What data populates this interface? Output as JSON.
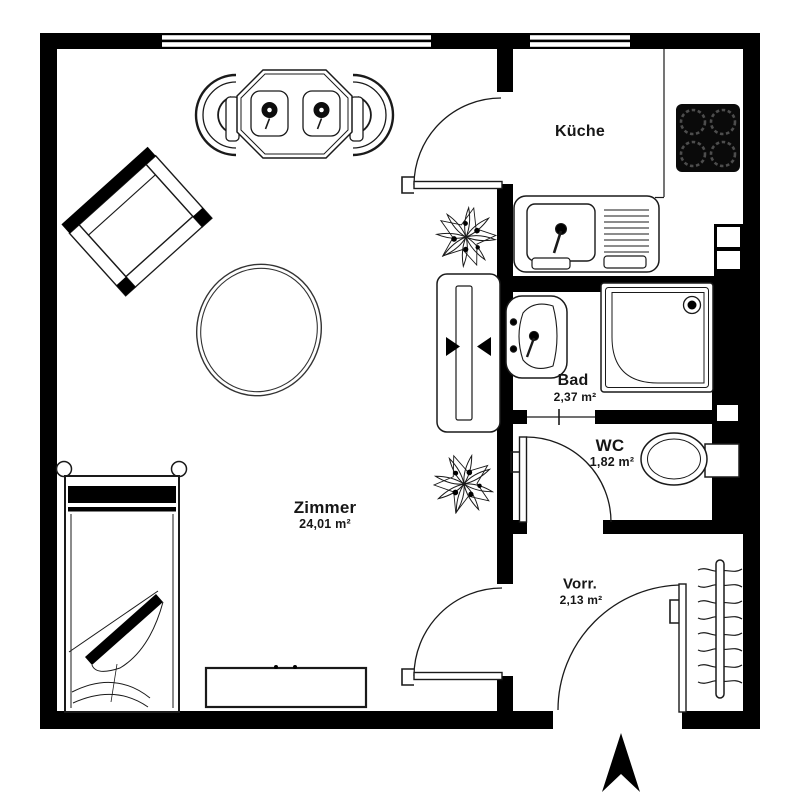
{
  "floorplan": {
    "type": "apartment-floor-plan",
    "rooms": {
      "zimmer": {
        "label": "Zimmer",
        "area": "24,01 m²"
      },
      "kueche": {
        "label": "Küche"
      },
      "bad": {
        "label": "Bad",
        "area": "2,37 m²"
      },
      "wc": {
        "label": "WC",
        "area": "1,82 m²"
      },
      "vorraum": {
        "label": "Vorr.",
        "area": "2,13 m²"
      }
    },
    "furniture": [
      "dining-table-with-two-chairs",
      "armchair",
      "oval-rug",
      "single-bed",
      "sideboard",
      "tv-board",
      "plant",
      "plant",
      "kitchen-counter",
      "kitchen-sink",
      "stove-4-burners",
      "washbasin",
      "shower",
      "toilet",
      "coat-rack",
      "north-arrow"
    ],
    "colors": {
      "wall": "#000000",
      "background": "#ffffff",
      "line": "#1a1a1a"
    }
  }
}
